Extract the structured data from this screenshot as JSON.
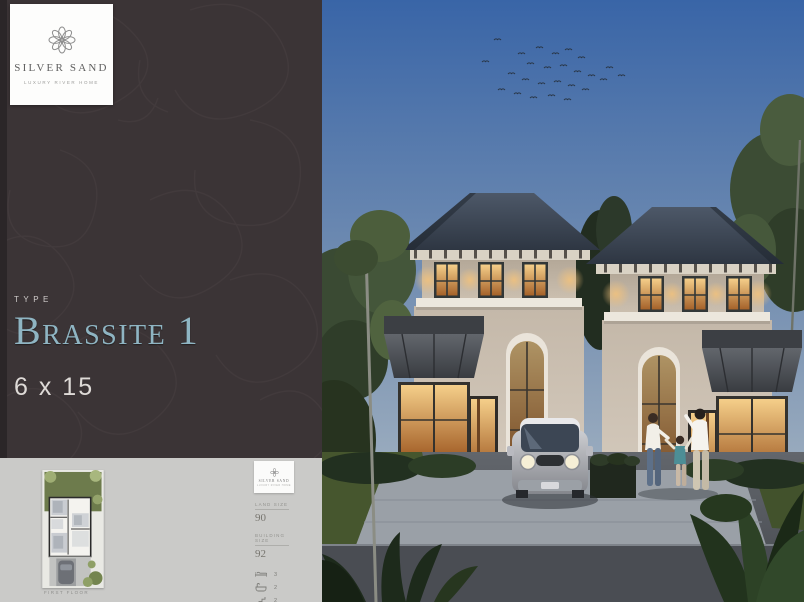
{
  "brand": {
    "name": "SILVER SAND",
    "tagline": "LUXURY RIVER HOME"
  },
  "hero": {
    "type_label": "TYPE",
    "type_name": "Brassite 1",
    "size": "6 x 15"
  },
  "plan_card": {
    "caption": "FIRST FLOOR",
    "metrics": [
      {
        "label": "LAND SIZE",
        "value": "90"
      },
      {
        "label": "BUILDING SIZE",
        "value": "92"
      }
    ],
    "specs": [
      {
        "icon": "bed-icon",
        "value": "3"
      },
      {
        "icon": "bath-icon",
        "value": "2"
      },
      {
        "icon": "stairs-icon",
        "value": "2"
      },
      {
        "icon": "car-icon",
        "value": "1 + 1"
      }
    ]
  },
  "render_scene": {
    "description": "Dusk render of two classical two-storey houses with hip roofs, lit windows, arched windows, metal awnings, silver mini car, family of three, tropical landscaping"
  },
  "colors": {
    "panel_bg": "#3b3436",
    "accent_teal": "#8fb5c3",
    "card_bg": "#cacac8",
    "sky_top": "#3a66a6",
    "sky_horizon": "#b7c2c9",
    "roof": "#39424f",
    "wall": "#cfc4b6",
    "window_glow": "#e8a95c"
  }
}
